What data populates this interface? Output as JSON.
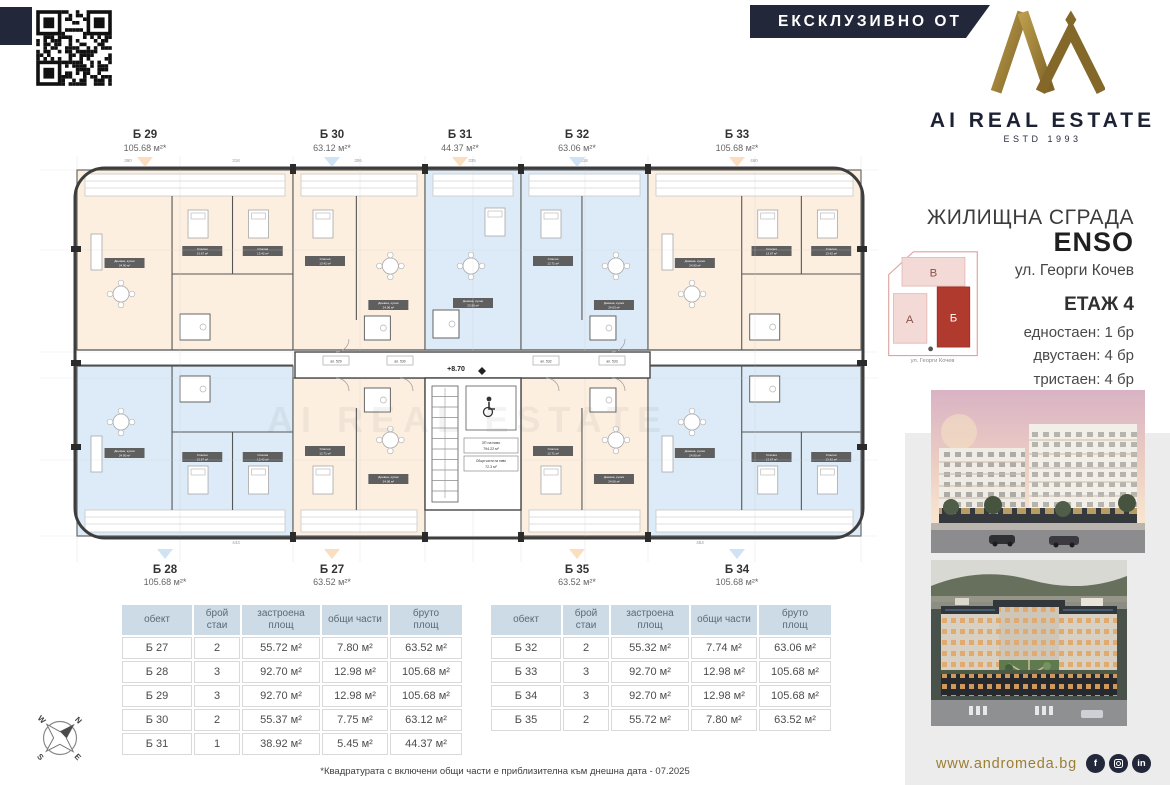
{
  "banner": {
    "label": "ЕКСКЛУЗИВНО ОТ"
  },
  "brand": {
    "name": "AI REAL ESTATE",
    "estd": "ESTD 1993"
  },
  "project": {
    "building_type": "ЖИЛИЩНА СГРАДА",
    "name": "ENSO",
    "address": "ул. Георги Кочев"
  },
  "floor_info": {
    "floor": "ЕТАЖ 4",
    "mix": [
      "едностаен: 1 бр",
      "двустаен: 4 бр",
      "тристаен: 4 бр"
    ]
  },
  "site_map": {
    "blocks": [
      {
        "label": "В"
      },
      {
        "label": "А"
      },
      {
        "label": "Б",
        "active": true
      }
    ],
    "street": "ул. Георги Кочев"
  },
  "floorplan": {
    "level_mark": "+8.70",
    "watermark": "AI REAL ESTATE",
    "stats": {
      "l1": "ЗП на ниво",
      "v1": "794.22 м²",
      "l2": "Общи части на ниво",
      "v2": "72.3 м²"
    },
    "corridor_tags": [
      "ап. 529",
      "ап. 530",
      "ап. 532",
      "ап. 533"
    ],
    "dim_numbers_top": [
      "390",
      "318",
      "306",
      "335",
      "318",
      "460"
    ],
    "dim_numbers_bottom": [
      "443",
      "453"
    ],
    "units_top": [
      {
        "id": "Б 29",
        "area": "105.68 м²*",
        "fill": "peach",
        "marker": "peach",
        "rooms": [
          [
            "Дневна, кухня",
            "24.90 м²"
          ],
          [
            "Спалня",
            "13.67 м²"
          ],
          [
            "Спалня",
            "13.42 м²"
          ]
        ]
      },
      {
        "id": "Б 30",
        "area": "63.12 м²*",
        "fill": "peach",
        "marker": "blue",
        "rooms": [
          [
            "Дневна, кухня",
            "24.06 м²"
          ],
          [
            "Спалня",
            "13.42 м²"
          ]
        ]
      },
      {
        "id": "Б 31",
        "area": "44.37 м²*",
        "fill": "blue",
        "marker": "peach",
        "rooms": [
          [
            "Дневна, кухня",
            "23.56 м²"
          ]
        ]
      },
      {
        "id": "Б 32",
        "area": "63.06 м²*",
        "fill": "blue",
        "marker": "blue",
        "rooms": [
          [
            "Дневна, кухня",
            "24.03 м²"
          ],
          [
            "Спалня",
            "12.71 м²"
          ]
        ]
      },
      {
        "id": "Б 33",
        "area": "105.68 м²*",
        "fill": "peach",
        "marker": "peach",
        "rooms": [
          [
            "Дневна, кухня",
            "24.90 м²"
          ],
          [
            "Спалня",
            "13.67 м²"
          ],
          [
            "Спалня",
            "13.42 м²"
          ]
        ]
      }
    ],
    "units_bottom": [
      {
        "id": "Б 28",
        "area": "105.68 м²*",
        "fill": "blue",
        "marker": "blue",
        "rooms": [
          [
            "Дневна, кухня",
            "24.90 м²"
          ],
          [
            "Спалня",
            "13.67 м²"
          ],
          [
            "Спалня",
            "13.42 м²"
          ]
        ]
      },
      {
        "id": "Б 27",
        "area": "63.52 м²*",
        "fill": "peach",
        "marker": "peach",
        "rooms": [
          [
            "Дневна, кухня",
            "24.06 м²"
          ],
          [
            "Спалня",
            "12.71 м²"
          ]
        ]
      },
      {
        "id": "Б 35",
        "area": "63.52 м²*",
        "fill": "peach",
        "marker": "peach",
        "rooms": [
          [
            "Дневна, кухня",
            "24.06 м²"
          ],
          [
            "Спалня",
            "12.71 м²"
          ]
        ]
      },
      {
        "id": "Б 34",
        "area": "105.68 м²*",
        "fill": "blue",
        "marker": "blue",
        "rooms": [
          [
            "Дневна, кухня",
            "24.90 м²"
          ],
          [
            "Спалня",
            "13.67 м²"
          ],
          [
            "Спалня",
            "13.42 м²"
          ]
        ]
      }
    ]
  },
  "tables": [
    {
      "headers": [
        "обект",
        "брой\nстаи",
        "застроена\nплощ",
        "общи части",
        "бруто\nплощ"
      ],
      "rows": [
        [
          "Б 27",
          "2",
          "55.72 м²",
          "7.80 м²",
          "63.52 м²"
        ],
        [
          "Б 28",
          "3",
          "92.70 м²",
          "12.98 м²",
          "105.68 м²"
        ],
        [
          "Б 29",
          "3",
          "92.70 м²",
          "12.98 м²",
          "105.68 м²"
        ],
        [
          "Б 30",
          "2",
          "55.37 м²",
          "7.75 м²",
          "63.12 м²"
        ],
        [
          "Б 31",
          "1",
          "38.92 м²",
          "5.45 м²",
          "44.37 м²"
        ]
      ]
    },
    {
      "headers": [
        "обект",
        "брой\nстаи",
        "застроена\nплощ",
        "общи части",
        "бруто\nплощ"
      ],
      "rows": [
        [
          "Б 32",
          "2",
          "55.32 м²",
          "7.74 м²",
          "63.06 м²"
        ],
        [
          "Б 33",
          "3",
          "92.70 м²",
          "12.98 м²",
          "105.68 м²"
        ],
        [
          "Б 34",
          "3",
          "92.70 м²",
          "12.98 м²",
          "105.68 м²"
        ],
        [
          "Б 35",
          "2",
          "55.72 м²",
          "7.80 м²",
          "63.52 м²"
        ]
      ]
    }
  ],
  "footnote": "*Квадратурата с включени общи части е приблизителна към днешна дата - 07.2025",
  "footer": {
    "website": "www.andromeda.bg",
    "socials": [
      "facebook",
      "instagram",
      "linkedin"
    ]
  },
  "compass": {
    "n": "N",
    "e": "E",
    "s": "S",
    "w": "W"
  },
  "colors": {
    "navy": "#23273a",
    "gold": "#97792f",
    "peach": "#fcefe0",
    "blue": "#dcebf7",
    "marker_peach": "#fbdcbc",
    "marker_blue": "#cde2f4",
    "accent_red": "#b03a2e"
  }
}
